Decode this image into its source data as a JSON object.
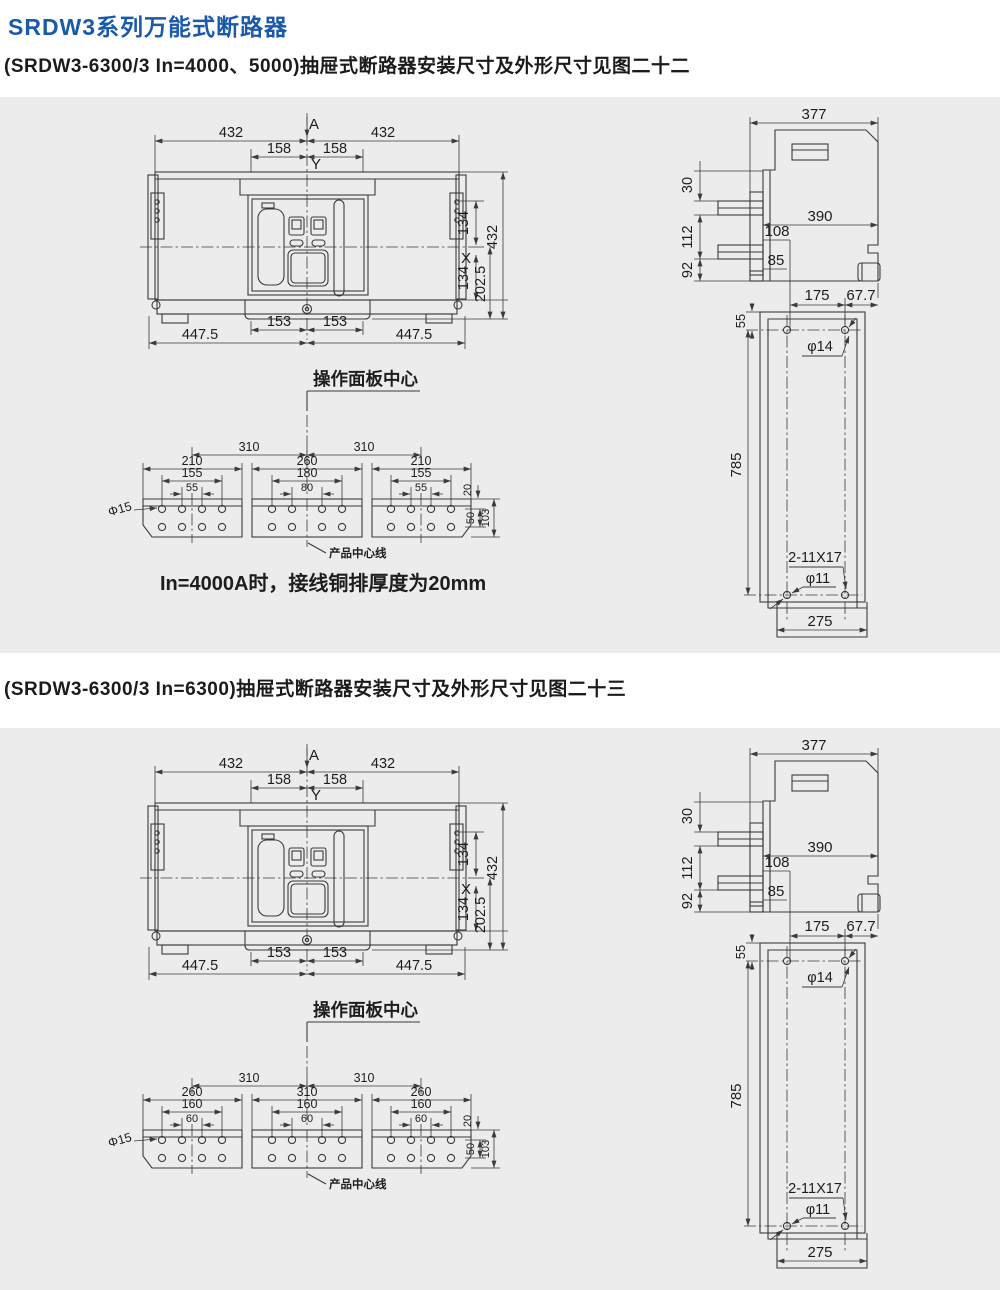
{
  "page": {
    "title": "SRDW3系列万能式断路器",
    "sections": [
      {
        "heading": "(SRDW3-6300/3 In=4000、5000)抽屉式断路器安装尺寸及外形尺寸见图二十二"
      },
      {
        "heading": "(SRDW3-6300/3 In=6300)抽屉式断路器安装尺寸及外形尺寸见图二十三"
      }
    ]
  },
  "colors": {
    "accent": "#1a5aab",
    "panel_bg": "#ececec",
    "line": "#3a3a3a"
  },
  "figure22": {
    "front": {
      "w1": "432",
      "w2": "432",
      "n1": "158",
      "n2": "158",
      "a": "A",
      "y": "Y",
      "x": "X",
      "r1": "134",
      "r2": "134",
      "r3": "202.5",
      "r4": "432",
      "b1": "153",
      "b2": "153",
      "c1": "447.5",
      "c2": "447.5",
      "center_label": "操作面板中心"
    },
    "bus": {
      "p1": "310",
      "p2": "310",
      "g1o": "210",
      "g1m": "155",
      "g1i": "55",
      "g2o": "260",
      "g2m": "180",
      "g2i": "80",
      "g3o": "210",
      "g3m": "155",
      "g3i": "55",
      "t20": "20",
      "t50": "50",
      "t103": "103",
      "hole": "Φ15",
      "centerline": "产品中心线",
      "note": "In=4000A时，接线铜排厚度为20mm"
    },
    "side": {
      "s377": "377",
      "s390": "390",
      "s30": "30",
      "s112": "112",
      "s92": "92",
      "s108": "108",
      "s85": "85"
    },
    "plate": {
      "q175": "175",
      "q67": "67.7",
      "q55": "55",
      "q785": "785",
      "q275": "275",
      "h14": "φ14",
      "slot": "2-11X17",
      "h11": "φ11"
    }
  },
  "figure23": {
    "front": {
      "w1": "432",
      "w2": "432",
      "n1": "158",
      "n2": "158",
      "a": "A",
      "y": "Y",
      "x": "X",
      "r1": "134",
      "r2": "134",
      "r3": "202.5",
      "r4": "432",
      "b1": "153",
      "b2": "153",
      "c1": "447.5",
      "c2": "447.5",
      "center_label": "操作面板中心"
    },
    "bus": {
      "p1": "310",
      "p2": "310",
      "g1o": "260",
      "g1m": "160",
      "g1i": "60",
      "g2o": "310",
      "g2m": "160",
      "g2i": "60",
      "g3o": "260",
      "g3m": "160",
      "g3i": "60",
      "t20": "20",
      "t50": "50",
      "t103": "103",
      "hole": "Φ15",
      "centerline": "产品中心线"
    },
    "side": {
      "s377": "377",
      "s390": "390",
      "s30": "30",
      "s112": "112",
      "s92": "92",
      "s108": "108",
      "s85": "85"
    },
    "plate": {
      "q175": "175",
      "q67": "67.7",
      "q55": "55",
      "q785": "785",
      "q275": "275",
      "h14": "φ14",
      "slot": "2-11X17",
      "h11": "φ11"
    }
  }
}
